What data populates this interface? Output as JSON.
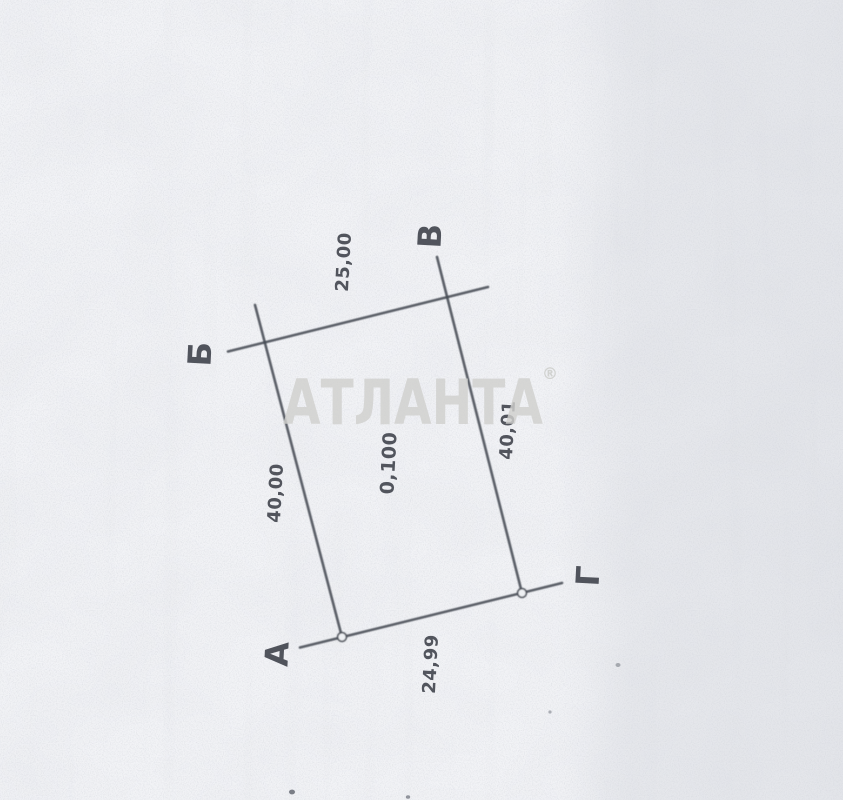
{
  "document": {
    "kind": "scanned land-plot sketch",
    "watermark": {
      "text": "АТЛАНТА",
      "reg_mark": "®"
    },
    "plot": {
      "area_label": "0,100",
      "corner_labels": {
        "top_left": "Б",
        "top_right": "В",
        "bottom_left": "А",
        "bottom_right": "Г"
      },
      "side_lengths": {
        "top": "25,00",
        "left": "40,00",
        "right": "40,01",
        "bottom": "24,99"
      },
      "sides": [
        {
          "from": "Б",
          "to": "В",
          "length": "25,00"
        },
        {
          "from": "В",
          "to": "Г",
          "length": "40,01"
        },
        {
          "from": "Б",
          "to": "А",
          "length": "40,00"
        },
        {
          "from": "А",
          "to": "Г",
          "length": "24,99"
        }
      ]
    },
    "colors": {
      "paper": "#f2f3f6",
      "ink": "#474b54",
      "watermark": "#cfd0cd"
    }
  }
}
